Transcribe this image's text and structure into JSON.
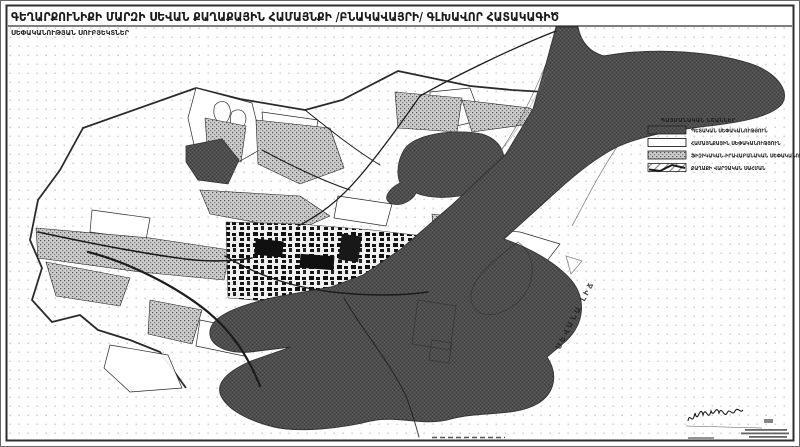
{
  "title": {
    "line1": "ԳԵՂԱՐՔՈՒՆԻՔԻ ՄԱՐԶԻ ՍԵՎԱՆ ՔԱՂԱՔԱՅԻՆ ՀԱՄԱՅՆՔԻ /ԲՆԱԿԱՎԱՅՐԻ/ ԳԼԽԱՎՈՐ ՀԱՏԱԿԱԳԻԾ",
    "line2": "ՍԵՓԱԿԱՆՈՒԹՅԱՆ ՍՈՒԲՅԵԿՏՆԵՐ"
  },
  "legend": {
    "title": "ՊԱՅՄԱՆԱԿԱՆ ՆՇԱՆՆԵՐ",
    "items": [
      {
        "label": "ՊԵՏԱԿԱՆ ՍԵՓԱԿԱՆՈՒԹՅՈՒՆ",
        "swatch": "dark-dither"
      },
      {
        "label": "ՀԱՄԱՅՆՔԱՅԻՆ ՍԵՓԱԿԱՆՈՒԹՅՈՒՆ",
        "swatch": "white"
      },
      {
        "label": "ՖԻԶԻԿԱԿԱՆ-ԻՐԱՎԱԲԱՆԱԿԱՆ ՍԵՓԱԿԱՆՈՒԹՅՈՒՆ",
        "swatch": "gray-dither"
      },
      {
        "label": "ՔԱՂԱՔԻ ՎԱՐՉԱԿԱՆ ՍԱՀՄԱՆ",
        "swatch": "boundary-line"
      }
    ]
  },
  "map": {
    "lake_label": "ՍԵՎԱՆԱ ԼԻՃ"
  },
  "colors": {
    "ink": "#1f1f1f",
    "lake_dark": "#4e4e4e",
    "parcel_gray": "#c0c0c0",
    "background": "#ffffff"
  }
}
